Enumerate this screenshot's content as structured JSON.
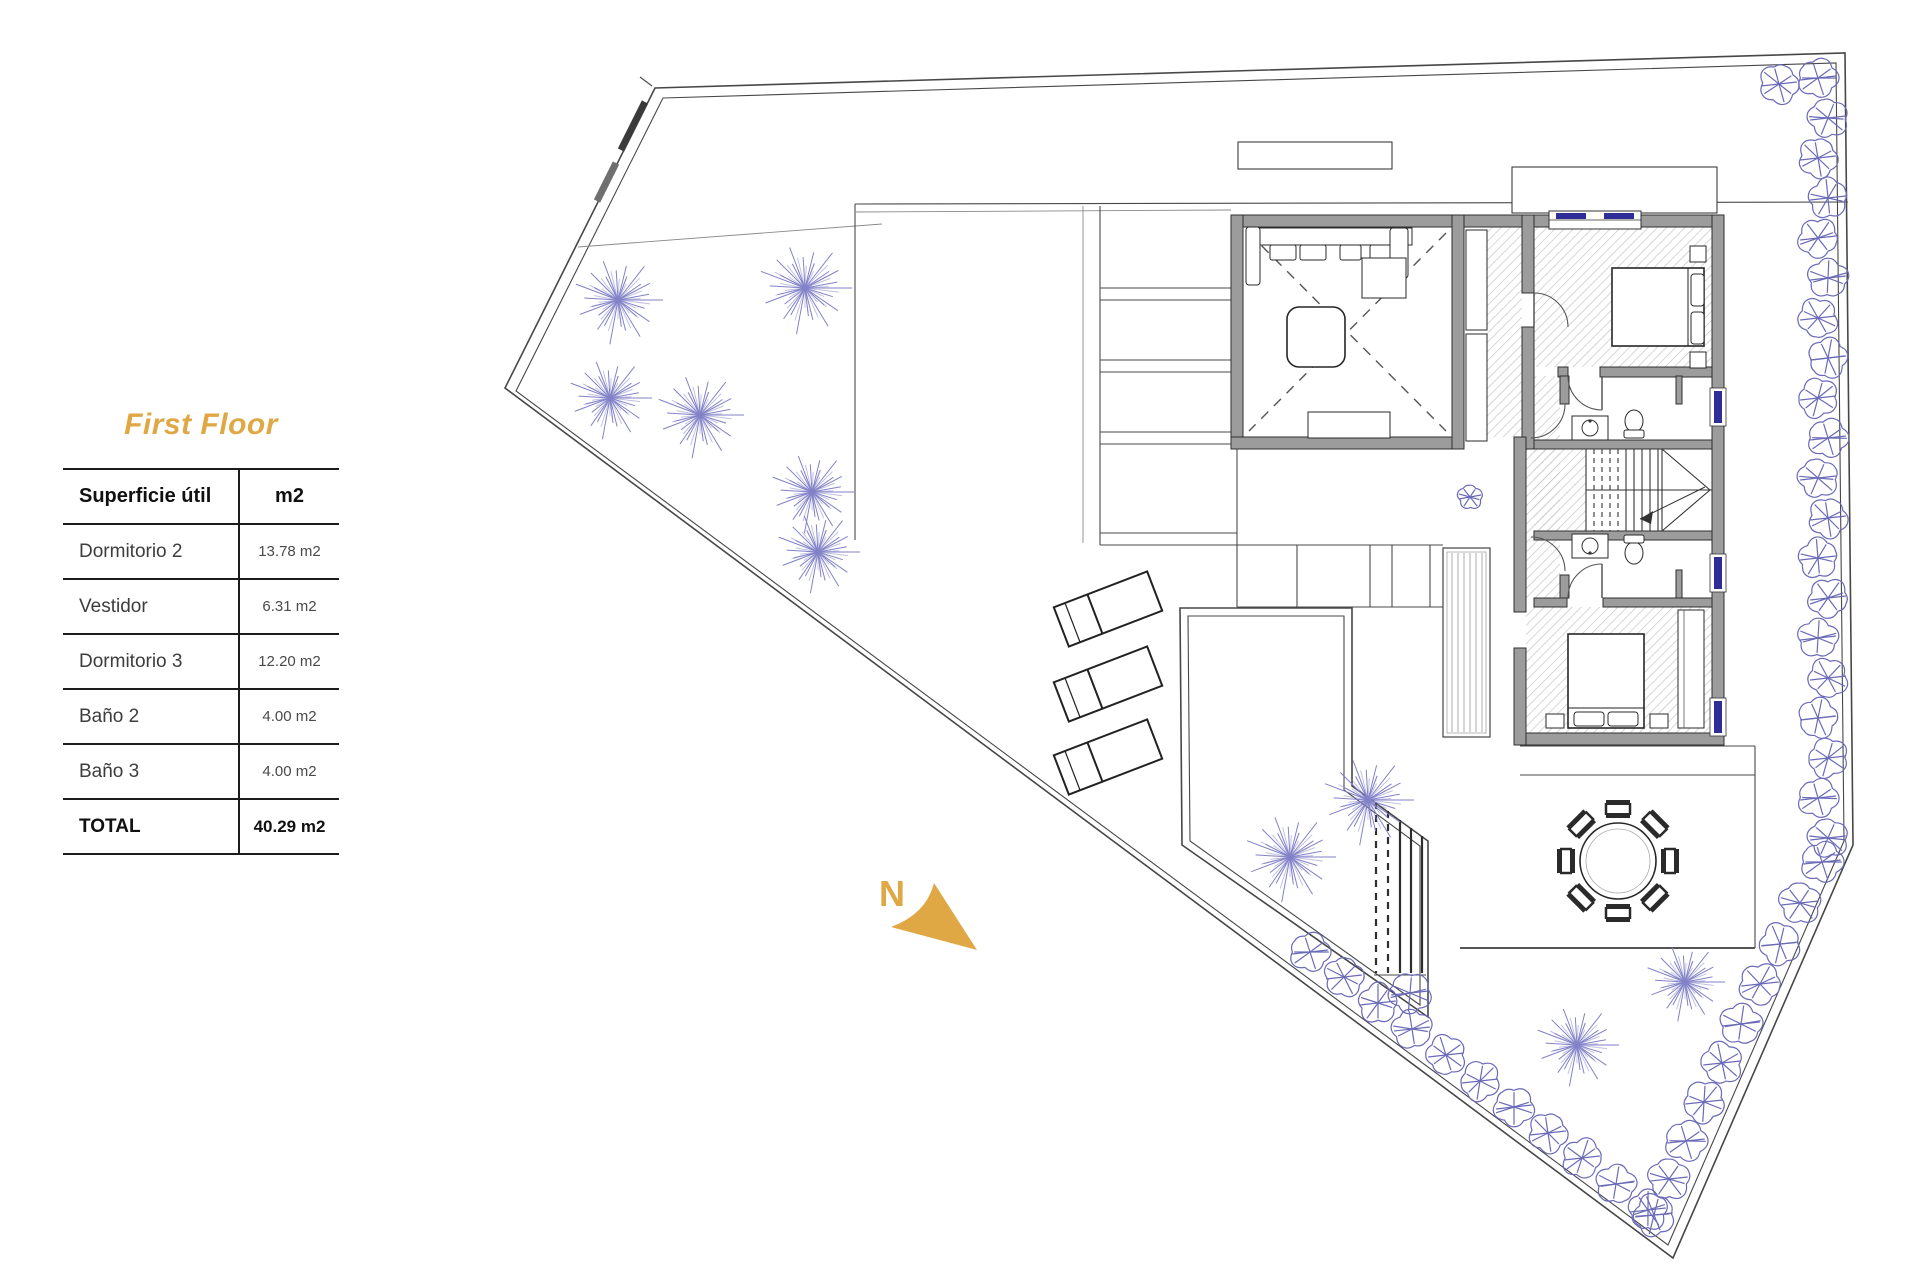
{
  "legend_panel": {
    "title": "First Floor",
    "table": {
      "columns": [
        "Superficie útil",
        "m2"
      ],
      "rows": [
        {
          "label": "Dormitorio 2",
          "value": "13.78 m2"
        },
        {
          "label": "Vestidor",
          "value": "6.31 m2"
        },
        {
          "label": "Dormitorio 3",
          "value": "12.20 m2"
        },
        {
          "label": "Baño 2",
          "value": "4.00 m2"
        },
        {
          "label": "Baño 3",
          "value": "4.00 m2"
        }
      ],
      "total": {
        "label": "TOTAL",
        "value": "40.29 m2"
      }
    }
  },
  "compass": {
    "label": "N"
  },
  "colors": {
    "accent_gold": "#DFA844",
    "tree_blue": "#8282C8",
    "bush_blue": "#6A6AB8",
    "wall_gray": "#9C9C9C",
    "wall_edge": "#2F2F2F",
    "window_navy": "#2E2E96",
    "hatch_gray": "#C6C6C6"
  }
}
